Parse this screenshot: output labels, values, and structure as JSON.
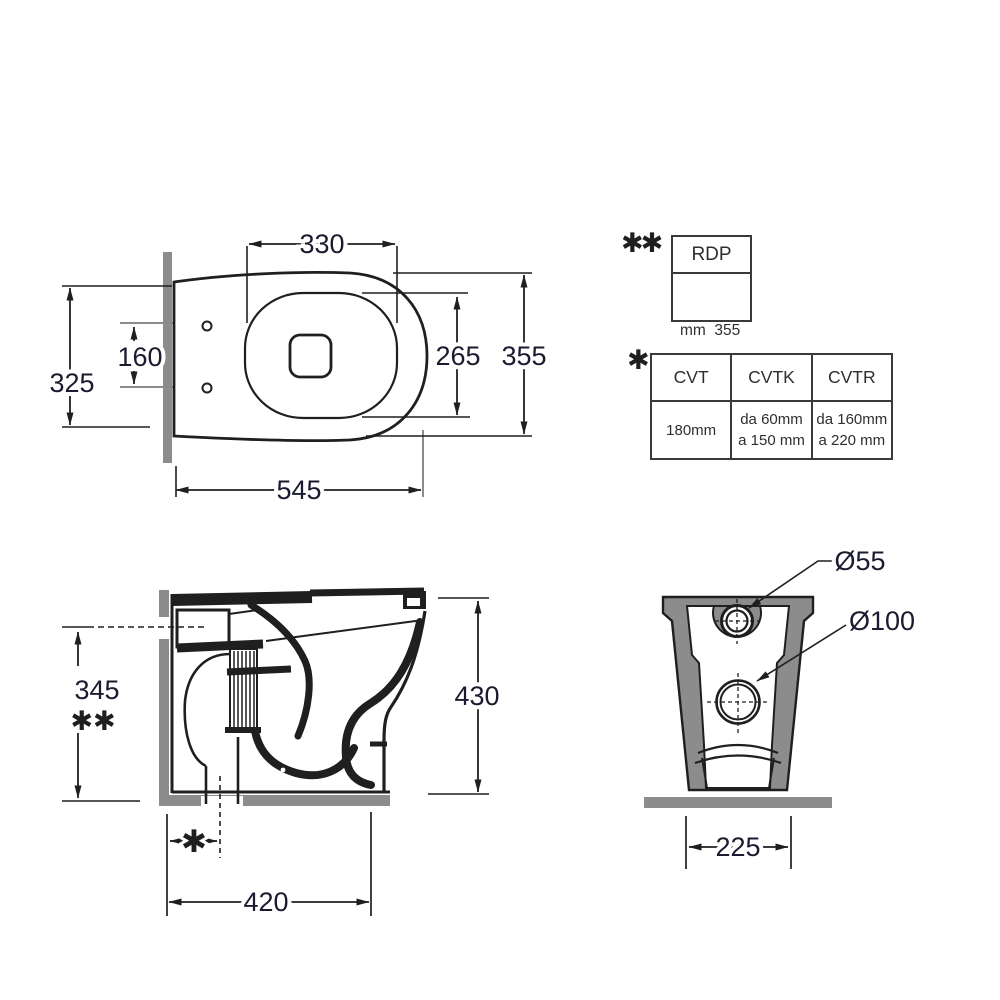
{
  "colors": {
    "line": "#1f1f1f",
    "dim_text": "#1b1b2f",
    "gray": "#8c8c8c"
  },
  "plan_view": {
    "seat_inner_width": "330",
    "overall_length": "545",
    "overall_depth_left": "325",
    "fixing_hole_spacing": "160",
    "bowl_inner_depth": "265",
    "overall_depth_right": "355"
  },
  "side_view": {
    "inlet_height": "345",
    "inlet_height_marker": "✱✱",
    "total_height": "430",
    "outlet_offset_marker": "✱",
    "base_depth": "420"
  },
  "rear_view": {
    "inlet_diameter": "Ø55",
    "outlet_diameter": "Ø100",
    "base_width": "225"
  },
  "rdp_table": {
    "marker": "✱✱",
    "header": "RDP",
    "line1": "mm  355",
    "line2": "o mm 325"
  },
  "cvt_table": {
    "marker": "✱",
    "headers": [
      "CVT",
      "CVTK",
      "CVTR"
    ],
    "cells": [
      [
        "180mm",
        ""
      ],
      [
        "da 60mm",
        "a 150 mm"
      ],
      [
        "da 160mm",
        "a 220 mm"
      ]
    ]
  }
}
